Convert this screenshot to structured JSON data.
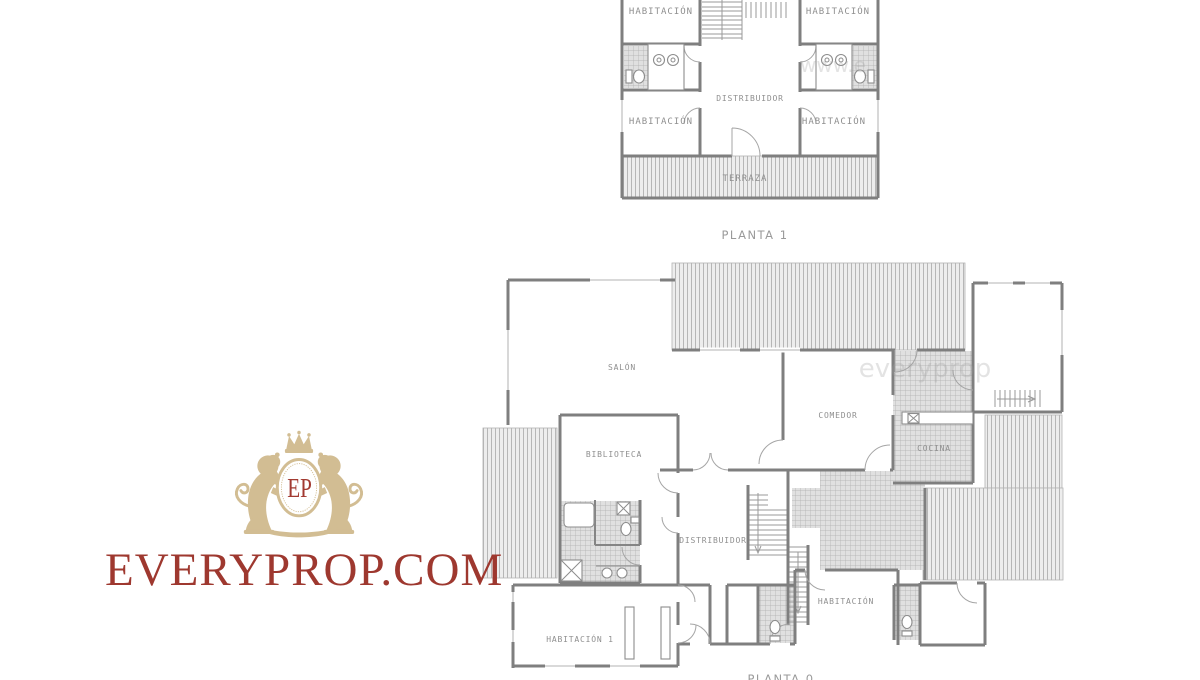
{
  "branding": {
    "monogram": "EP",
    "site_name": "EVERYPROP.COM",
    "gold_color": "#d2bd93",
    "red_color": "#9e382f"
  },
  "watermarks": {
    "plan_top": "www.e",
    "plan_bottom": "everyprop"
  },
  "floor_plans": [
    {
      "caption": "PLANTA 1",
      "labels": {
        "bedroom_top_left": "HABITACIÓN",
        "bedroom_top_right": "HABITACIÓN",
        "bedroom_mid_left": "HABITACIÓN",
        "bedroom_mid_right": "HABITACIÓN",
        "hall": "DISTRIBUIDOR",
        "terrace": "TERRAZA"
      }
    },
    {
      "caption": "PLANTA 0",
      "labels": {
        "living_room": "SALÓN",
        "dining_room": "COMEDOR",
        "kitchen": "COCINA",
        "library": "BIBLIOTECA",
        "hall": "DISTRIBUIDOR",
        "bedroom": "HABITACIÓN",
        "bedroom_1": "HABITACIÓN 1"
      }
    }
  ]
}
